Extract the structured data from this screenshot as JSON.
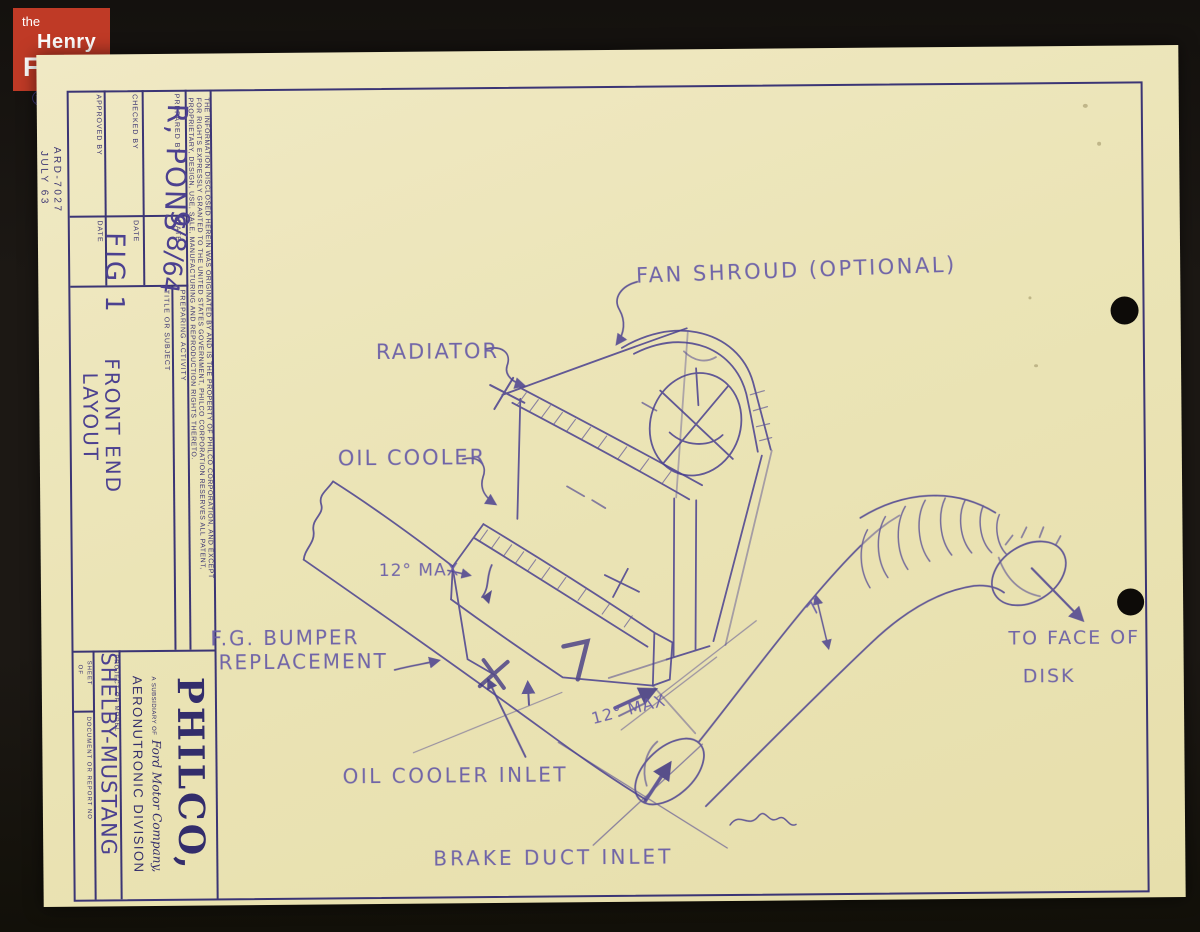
{
  "archive_logo": {
    "line1": "the",
    "line2": "Henry",
    "line3": "Ford"
  },
  "margin": {
    "ford_oval": "Ford",
    "doc_number": "ARD-7027",
    "doc_date": "JULY 63"
  },
  "title_block": {
    "legal_line1": "THE INFORMATION DISCLOSED HEREIN WAS ORIGINATED BY AND IS THE PROPERTY OF PHILCO CORPORATION, AND EXCEPT",
    "legal_line2": "FOR RIGHTS EXPRESSLY GRANTED TO THE UNITED STATES GOVERNMENT, PHILCO CORPORATION RESERVES ALL PATENT,",
    "legal_line3": "PROPRIETARY, DESIGN, USE, SALE, MANUFACTURING AND REPRODUCTION RIGHTS THERETO.",
    "prepared_by_label": "PREPARED BY",
    "prepared_by_value": "R, PONS",
    "date_label": "DATE",
    "prepared_date_value": "9/8/64",
    "checked_by_label": "CHECKED BY",
    "approved_by_label": "APPROVED BY",
    "preparing_activity_label": "PREPARING ACTIVITY",
    "title_label": "TITLE OR SUBJECT",
    "title_value_1": "FIG 1",
    "title_value_2": "FRONT END",
    "title_value_3": "LAYOUT",
    "philco_name": "PHILCO,",
    "subsidiary_label": "A SUBSIDIARY OF",
    "subsidiary_company": "Ford Motor Company,",
    "division": "AERONUTRONIC DIVISION",
    "project_label": "PROJECT OR MODEL",
    "project_value": "SHELBY-MUSTANG",
    "sheet_label": "SHEET",
    "of_label": "OF",
    "document_label": "DOCUMENT OR REPORT NO"
  },
  "drawing_labels": {
    "fan_shroud": "FAN SHROUD (OPTIONAL)",
    "radiator": "RADIATOR",
    "oil_cooler": "OIL COOLER",
    "angle_max_left": "12° MAX",
    "bumper_line1": "F.G. BUMPER",
    "bumper_line2": "REPLACEMENT",
    "oil_cooler_inlet": "OIL COOLER INLET",
    "angle_max_right": "12° MAX",
    "brake_duct_inlet": "BRAKE DUCT INLET",
    "dim_seven": "7″",
    "to_face_line1": "TO FACE OF",
    "to_face_line2": "DISK"
  },
  "colors": {
    "ink": "#4a4090",
    "print": "#3b3575",
    "paper": "#ebe4b6",
    "logo_red": "#bf3a26",
    "background": "#1c1814"
  }
}
